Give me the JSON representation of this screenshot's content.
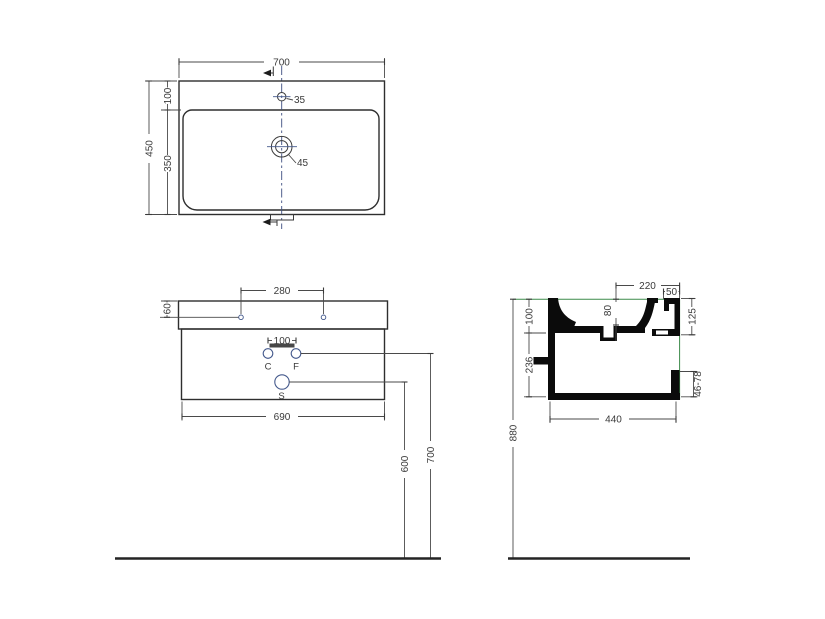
{
  "top_view": {
    "width": "700",
    "height": "450",
    "back_depth": "100",
    "front_depth": "350",
    "faucet_hole": "35",
    "drain_hole": "45"
  },
  "front_view": {
    "hole_spacing": "280",
    "hole_offset": "60",
    "cf_spacing": "100",
    "cabinet_width": "690",
    "label_c": "C",
    "label_f": "F",
    "label_s": "S",
    "drain_height": "600",
    "supply_height": "700"
  },
  "side_view": {
    "top_depth": "220",
    "rear_ledge": "50",
    "bowl_depth": "80",
    "basin_height": "100",
    "rear_height": "125",
    "cabinet_height": "236",
    "bottom_depth": "440",
    "gap_range": "46-78",
    "total_height": "880"
  },
  "colors": {
    "line": "#3a3a3a",
    "section_fill": "#0b0b0b",
    "accent_green": "#3d8b4a",
    "accent_blue": "#44598c"
  }
}
